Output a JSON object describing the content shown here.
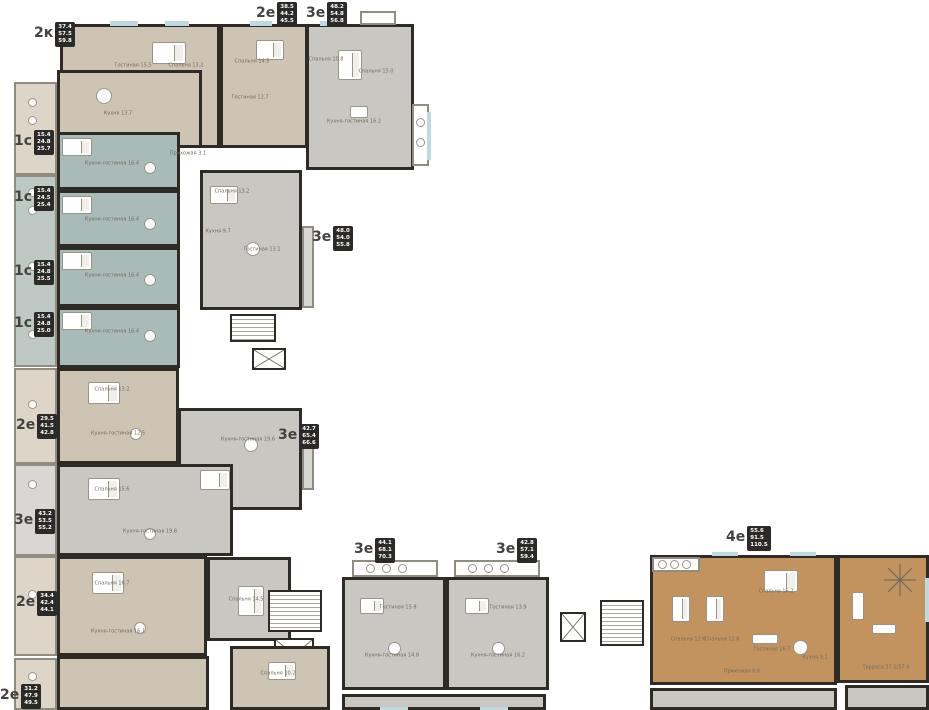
{
  "title": "Floor plan of residential building with apartment types and areas",
  "colors": {
    "wall": "#2e2b27",
    "beige": "#cec4b4",
    "beige_light": "#ddd5c7",
    "teal": "#a9bbb8",
    "teal_light": "#bec9c6",
    "gray": "#c9c7c2",
    "gray_light": "#d9d7d3",
    "brown": "#c2935f",
    "window": "#bfd9df",
    "badge_bg": "#2b2a28",
    "badge_text": "#ffffff"
  },
  "apartments": [
    {
      "id": "apt-2k-top",
      "type": "2к",
      "a1": "37.4",
      "a2": "57.5",
      "a3": "59.8",
      "lx": 34,
      "ly": 22
    },
    {
      "id": "apt-2e-top",
      "type": "2е",
      "a1": "38.5",
      "a2": "44.2",
      "a3": "45.5",
      "lx": 256,
      "ly": 2
    },
    {
      "id": "apt-3e-top",
      "type": "3е",
      "a1": "48.2",
      "a2": "54.8",
      "a3": "56.8",
      "lx": 306,
      "ly": 2
    },
    {
      "id": "apt-1s-1",
      "type": "1с",
      "a1": "15.4",
      "a2": "24.8",
      "a3": "25.7",
      "lx": 14,
      "ly": 130
    },
    {
      "id": "apt-1s-2",
      "type": "1с",
      "a1": "15.4",
      "a2": "24.5",
      "a3": "25.4",
      "lx": 14,
      "ly": 186
    },
    {
      "id": "apt-1s-3",
      "type": "1с",
      "a1": "15.4",
      "a2": "24.8",
      "a3": "25.5",
      "lx": 14,
      "ly": 260
    },
    {
      "id": "apt-1s-4",
      "type": "1с",
      "a1": "15.4",
      "a2": "24.8",
      "a3": "25.0",
      "lx": 14,
      "ly": 312
    },
    {
      "id": "apt-3e-mid-top",
      "type": "3е",
      "a1": "48.0",
      "a2": "54.0",
      "a3": "55.8",
      "lx": 312,
      "ly": 226
    },
    {
      "id": "apt-2e-left-1",
      "type": "2е",
      "a1": "29.5",
      "a2": "41.5",
      "a3": "42.8",
      "lx": 16,
      "ly": 414
    },
    {
      "id": "apt-3e-mid",
      "type": "3е",
      "a1": "42.7",
      "a2": "65.4",
      "a3": "66.6",
      "lx": 278,
      "ly": 424
    },
    {
      "id": "apt-3e-left",
      "type": "3е",
      "a1": "43.2",
      "a2": "53.5",
      "a3": "55.2",
      "lx": 14,
      "ly": 509
    },
    {
      "id": "apt-2e-left-2",
      "type": "2е",
      "a1": "34.4",
      "a2": "42.4",
      "a3": "44.1",
      "lx": 16,
      "ly": 591
    },
    {
      "id": "apt-2e-bottom-left",
      "type": "2е",
      "a1": "31.2",
      "a2": "47.9",
      "a3": "49.5",
      "lx": 0,
      "ly": 684
    },
    {
      "id": "apt-3e-bottom-1",
      "type": "3е",
      "a1": "44.1",
      "a2": "68.1",
      "a3": "70.3",
      "lx": 354,
      "ly": 538
    },
    {
      "id": "apt-3e-bottom-2",
      "type": "3е",
      "a1": "42.8",
      "a2": "57.1",
      "a3": "59.4",
      "lx": 496,
      "ly": 538
    },
    {
      "id": "apt-4e-right",
      "type": "4е",
      "a1": "55.6",
      "a2": "91.5",
      "a3": "110.5",
      "lx": 726,
      "ly": 526
    }
  ],
  "room_labels": [
    {
      "t": "Гостиная 15.5",
      "x": 133,
      "y": 66
    },
    {
      "t": "Спальня 13.2",
      "x": 186,
      "y": 66
    },
    {
      "t": "Кухня 13.7",
      "x": 118,
      "y": 114
    },
    {
      "t": "Спальня 14.5",
      "x": 252,
      "y": 62
    },
    {
      "t": "Гостиная 12.7",
      "x": 250,
      "y": 98
    },
    {
      "t": "Спальня 10.8",
      "x": 326,
      "y": 60
    },
    {
      "t": "Спальня 15.0",
      "x": 376,
      "y": 72
    },
    {
      "t": "Кухня-гостиная 16.2",
      "x": 354,
      "y": 122
    },
    {
      "t": "Кухня-гостиная 16.4",
      "x": 112,
      "y": 164
    },
    {
      "t": "Кухня-гостиная 16.4",
      "x": 112,
      "y": 220
    },
    {
      "t": "Кухня-гостиная 16.4",
      "x": 112,
      "y": 276
    },
    {
      "t": "Кухня-гостиная 16.4",
      "x": 112,
      "y": 332
    },
    {
      "t": "Спальня 13.2",
      "x": 232,
      "y": 192
    },
    {
      "t": "Кухня 9.7",
      "x": 218,
      "y": 232
    },
    {
      "t": "Гостиная 13.1",
      "x": 262,
      "y": 250
    },
    {
      "t": "Спальня 13.2",
      "x": 112,
      "y": 390
    },
    {
      "t": "Кухня-гостиная 12.5",
      "x": 118,
      "y": 434
    },
    {
      "t": "Кухня-гостиная 19.6",
      "x": 248,
      "y": 440
    },
    {
      "t": "Спальня 15.6",
      "x": 112,
      "y": 490
    },
    {
      "t": "Кухня-гостиная 19.8",
      "x": 150,
      "y": 532
    },
    {
      "t": "Спальня 16.7",
      "x": 112,
      "y": 584
    },
    {
      "t": "Кухня-гостиная 16.1",
      "x": 118,
      "y": 632
    },
    {
      "t": "Спальня 14.5",
      "x": 246,
      "y": 600
    },
    {
      "t": "Спальня 10.2",
      "x": 278,
      "y": 674
    },
    {
      "t": "Гостиная 15.8",
      "x": 398,
      "y": 608
    },
    {
      "t": "Кухня-гостиная 14.8",
      "x": 392,
      "y": 656
    },
    {
      "t": "Гостиная 13.9",
      "x": 508,
      "y": 608
    },
    {
      "t": "Кухня-гостиная 16.2",
      "x": 498,
      "y": 656
    },
    {
      "t": "Спальня 12.6",
      "x": 688,
      "y": 640
    },
    {
      "t": "Спальня 12.6",
      "x": 722,
      "y": 640
    },
    {
      "t": "Спальня 16.2",
      "x": 776,
      "y": 592
    },
    {
      "t": "Гостиная 16.7",
      "x": 772,
      "y": 650
    },
    {
      "t": "Кухня 9.1",
      "x": 815,
      "y": 658
    },
    {
      "t": "Прихожая 6.6",
      "x": 742,
      "y": 672
    },
    {
      "t": "Терраса 17.1/57.4",
      "x": 886,
      "y": 668
    },
    {
      "t": "Прихожая 3.1",
      "x": 188,
      "y": 154
    }
  ]
}
